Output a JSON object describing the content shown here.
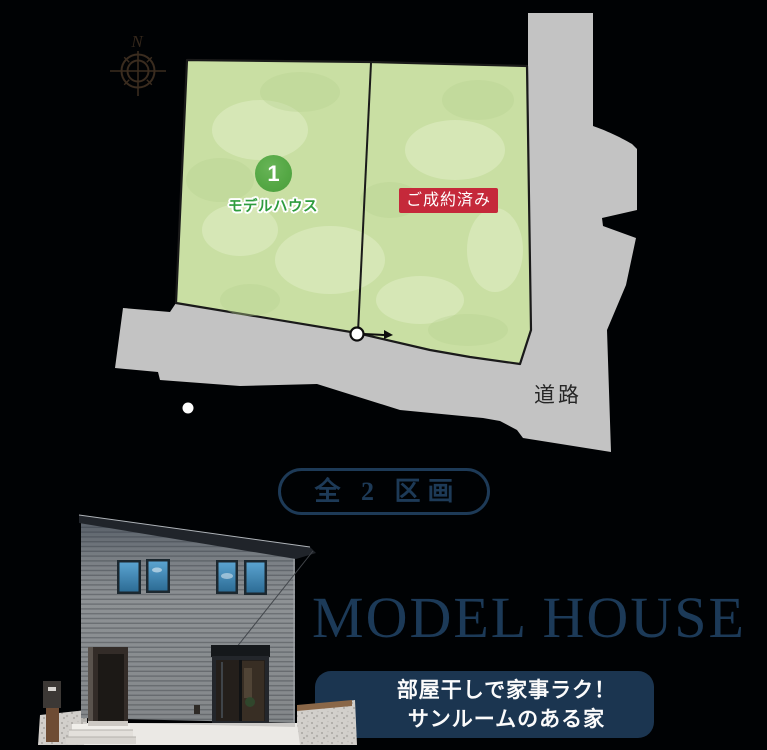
{
  "site_plan": {
    "compass_label": "N",
    "road_label": "道路",
    "lot1": {
      "number": "1",
      "label": "モデルハウス"
    },
    "lot2": {
      "status": "ご成約済み"
    }
  },
  "summary": {
    "total_lots_badge": "全 2 区画"
  },
  "model_house": {
    "heading": "MODEL HOUSE",
    "banner_line1": "部屋干しで家事ラク！",
    "banner_line2": "サンルームのある家"
  },
  "colors": {
    "background": "#000204",
    "navy": "#1b3550",
    "plot_green": "#c9dfa3",
    "marker_green": "#55a845",
    "label_green": "#2e9c3e",
    "sold_red": "#c5293a",
    "road_gray": "#c3c3c3",
    "compass_brown": "#3a2c1f"
  }
}
